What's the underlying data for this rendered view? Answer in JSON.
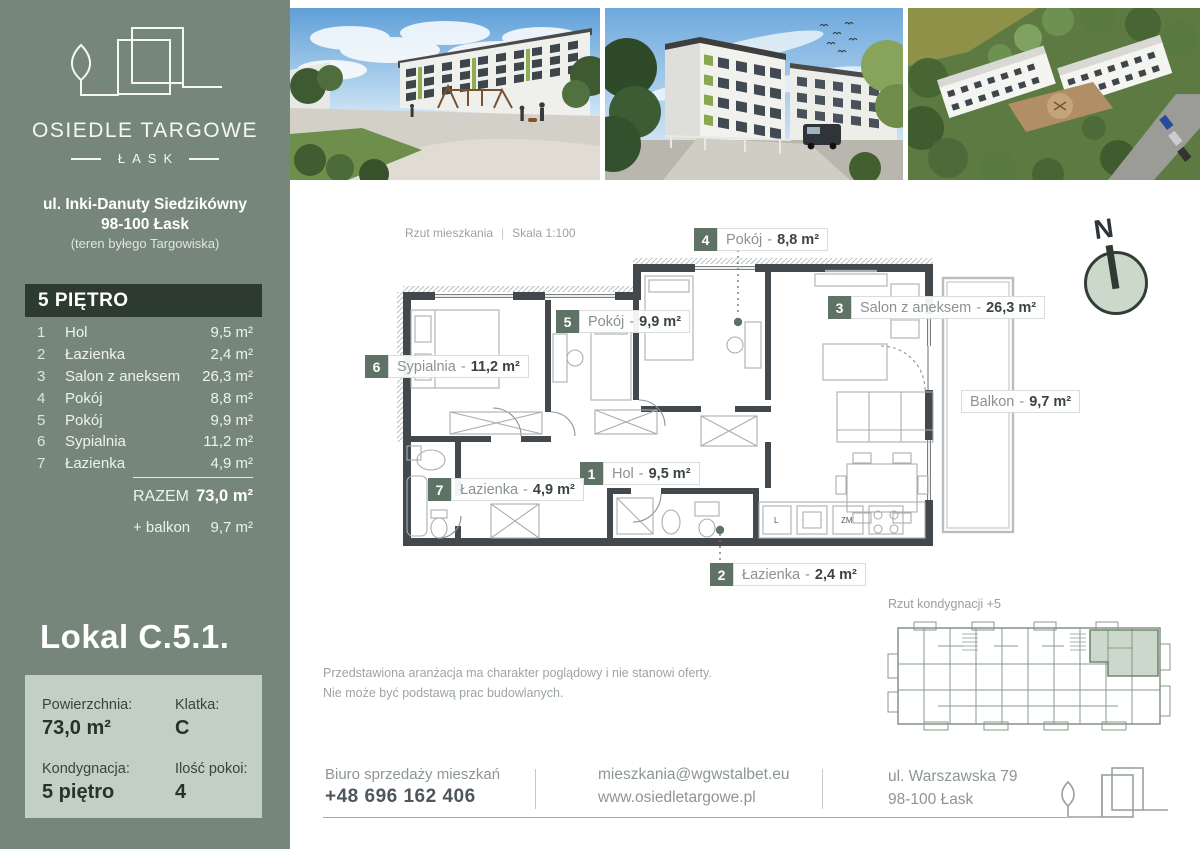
{
  "colors": {
    "sidebar_green": "#77867b",
    "panel_dark": "#2c3a30",
    "panel_light": "#c3cfc2",
    "chip_green": "#5e7365",
    "wall_gray": "#43484c",
    "highlight_sage": "#ccd8cb"
  },
  "sidebar": {
    "brand": {
      "name": "OSIEDLE TARGOWE",
      "sub": "ŁASK"
    },
    "address_line1": "ul. Inki-Danuty Siedzikówny",
    "address_line2": "98-100 Łask",
    "address_line3": "(teren byłego Targowiska)",
    "floor_header": "5 PIĘTRO",
    "rooms": [
      {
        "no": "1",
        "name": "Hol",
        "area": "9,5 m²"
      },
      {
        "no": "2",
        "name": "Łazienka",
        "area": "2,4 m²"
      },
      {
        "no": "3",
        "name": "Salon z aneksem",
        "area": "26,3 m²"
      },
      {
        "no": "4",
        "name": "Pokój",
        "area": "8,8 m²"
      },
      {
        "no": "5",
        "name": "Pokój",
        "area": "9,9 m²"
      },
      {
        "no": "6",
        "name": "Sypialnia",
        "area": "11,2 m²"
      },
      {
        "no": "7",
        "name": "Łazienka",
        "area": "4,9 m²"
      }
    ],
    "total_label": "RAZEM",
    "total_value": "73,0 m²",
    "balcony_label": "+ balkon",
    "balcony_value": "9,7 m²",
    "unit_title": "Lokal C.5.1.",
    "info": {
      "area_label": "Powierzchnia:",
      "area_value": "73,0 m²",
      "stair_label": "Klatka:",
      "stair_value": "C",
      "storey_label": "Kondygnacja:",
      "storey_value": "5 piętro",
      "rooms_label": "Ilość pokoi:",
      "rooms_value": "4"
    }
  },
  "plan": {
    "caption": "Rzut mieszkania",
    "separator": "|",
    "scale": "Skala 1:100",
    "label_sep": "-",
    "labels": [
      {
        "no": "4",
        "name": "Pokój",
        "area": "8,8 m²"
      },
      {
        "no": "3",
        "name": "Salon z aneksem",
        "area": "26,3 m²"
      },
      {
        "no": "5",
        "name": "Pokój",
        "area": "9,9 m²"
      },
      {
        "no": "6",
        "name": "Sypialnia",
        "area": "11,2 m²"
      },
      {
        "no": "1",
        "name": "Hol",
        "area": "9,5 m²"
      },
      {
        "no": "7",
        "name": "Łazienka",
        "area": "4,9 m²"
      },
      {
        "no": "2",
        "name": "Łazienka",
        "area": "2,4 m²"
      }
    ],
    "balcony": {
      "name": "Balkon",
      "area": "9,7 m²"
    },
    "kitchen_l": "L",
    "kitchen_zm": "ZM",
    "compass_n": "N"
  },
  "disclaimer": {
    "line1": "Przedstawiona aranżacja ma charakter poglądowy i nie stanowi oferty.",
    "line2": "Nie może być podstawą prac budowlanych."
  },
  "section_plan": {
    "caption": "Rzut kondygnacji +5"
  },
  "footer": {
    "office_label": "Biuro sprzedaży mieszkań",
    "phone": "+48 696 162 406",
    "email": "mieszkania@wgwstalbet.eu",
    "website": "www.osiedletargowe.pl",
    "address1": "ul. Warszawska 79",
    "address2": "98-100 Łask"
  }
}
